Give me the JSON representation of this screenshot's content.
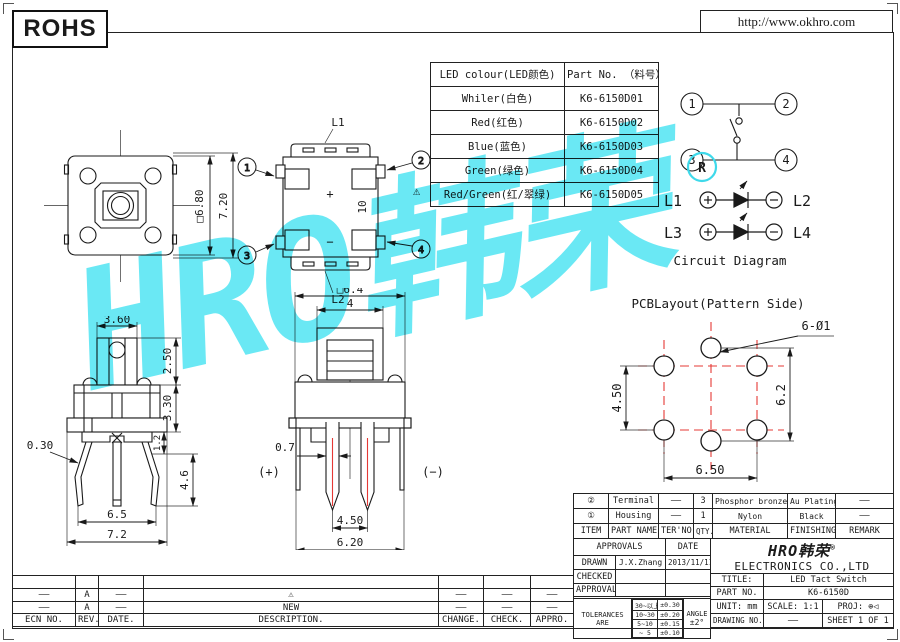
{
  "misc": {
    "dash": "——",
    "warning": "⚠"
  },
  "colors": {
    "watermark_cyan": "#44e3f2",
    "centerline_red": "#e53935",
    "ink": "#1a1a1a"
  },
  "header": {
    "rohs": "ROHS",
    "url": "http://www.okhro.com"
  },
  "led_table": {
    "col_colour": "LED colour(LED颜色)",
    "col_part": "Part No. （料号）",
    "rows": [
      {
        "colour": "Whiler(白色)",
        "part": "K6-6150D01"
      },
      {
        "colour": "Red(红色)",
        "part": "K6-6150D02"
      },
      {
        "colour": "Blue(蓝色)",
        "part": "K6-6150D03"
      },
      {
        "colour": "Green(绿色)",
        "part": "K6-6150D04"
      },
      {
        "colour": "Red/Green(红/翠绿)",
        "part": "K6-6150D05"
      }
    ]
  },
  "circuit": {
    "t1": "1",
    "t2": "2",
    "t3": "3",
    "t4": "4",
    "l1": "L1",
    "l2": "L2",
    "l3": "L3",
    "l4": "L4",
    "reg": "R",
    "caption": "Circuit Diagram"
  },
  "pcb": {
    "title": "PCBLayout(Pattern Side)",
    "holes": "6-Ø1",
    "dim_left": "4.50",
    "dim_right": "6.2",
    "dim_bottom": "6.50"
  },
  "top_view": {
    "dim_square": "□6.80",
    "dim_overall": "7.20"
  },
  "bottom_view": {
    "l1": "L1",
    "l2": "L2",
    "dim_height": "10",
    "plus": "+",
    "minus": "−",
    "t1": "1",
    "t2": "2",
    "t3": "3",
    "t4": "4"
  },
  "side_view": {
    "w_top": "3.60",
    "h_cap": "2.50",
    "h_body": "3.30",
    "h_standoff": "1.2",
    "h_pin": "4.6",
    "pin_t": "0.30",
    "w_pins": "6.5",
    "w_total": "7.2"
  },
  "front_view": {
    "square": "□6.4",
    "btn_w": "4",
    "pin_w": "0.7",
    "plus": "(+)",
    "minus": "(−)",
    "pitch": "4.50",
    "width": "6.20"
  },
  "parts_table": {
    "h_item": "ITEM",
    "h_name": "PART NAME",
    "h_ter": "TER'NO.",
    "h_qty": "QTY.",
    "h_material": "MATERIAL",
    "h_finishing": "FINISHING",
    "h_remark": "REMARK",
    "rows": [
      {
        "item": "②",
        "name": "Terminal",
        "ter": "——",
        "qty": "3",
        "material": "Phosphor bronze",
        "finishing": "Au Plating",
        "remark": "——"
      },
      {
        "item": "①",
        "name": "Housing",
        "ter": "——",
        "qty": "1",
        "material": "Nylon",
        "finishing": "Black",
        "remark": "——"
      }
    ]
  },
  "approvals": {
    "header": "APPROVALS",
    "date": "DATE",
    "drawn_label": "DRAWN",
    "drawn_name": "J.X.Zhang",
    "drawn_date": "2013/11/11",
    "checked_label": "CHECKED",
    "approvals_label": "APPROVALS",
    "tol_label": "TOLERANCES ARE",
    "tol": [
      [
        "30~以上",
        "±0.30"
      ],
      [
        "10~30",
        "±0.20"
      ],
      [
        "5~10",
        "±0.15"
      ],
      [
        "~ 5",
        "±0.10"
      ]
    ],
    "angle_label": "ANGLE",
    "angle_value": "±2°"
  },
  "company": {
    "logo": "HRO韩荣",
    "reg": "®",
    "name": "ELECTRONICS CO.,LTD"
  },
  "title_block": {
    "title_label": "TITLE:",
    "title_value": "LED Tact Switch",
    "part_label": "PART NO.",
    "part_value": "K6-6150D",
    "unit": "UNIT: mm",
    "scale": "SCALE: 1:1",
    "proj_label": "PROJ:",
    "proj_icon": "⊕◁",
    "drawing_label": "DRAWING NO.",
    "sheet": "SHEET 1 OF 1"
  },
  "revision": {
    "h_ecn": "ECN NO.",
    "h_rev": "REV.",
    "h_date": "DATE.",
    "h_desc": "DESCRIPTION.",
    "h_change": "CHANGE.",
    "h_check": "CHECK.",
    "h_appro": "APPRO.",
    "rows": [
      {
        "rev": "A",
        "desc": "⚠"
      },
      {
        "rev": "A",
        "desc": "NEW"
      }
    ]
  },
  "watermark": {
    "text": "HRO韩荣"
  }
}
